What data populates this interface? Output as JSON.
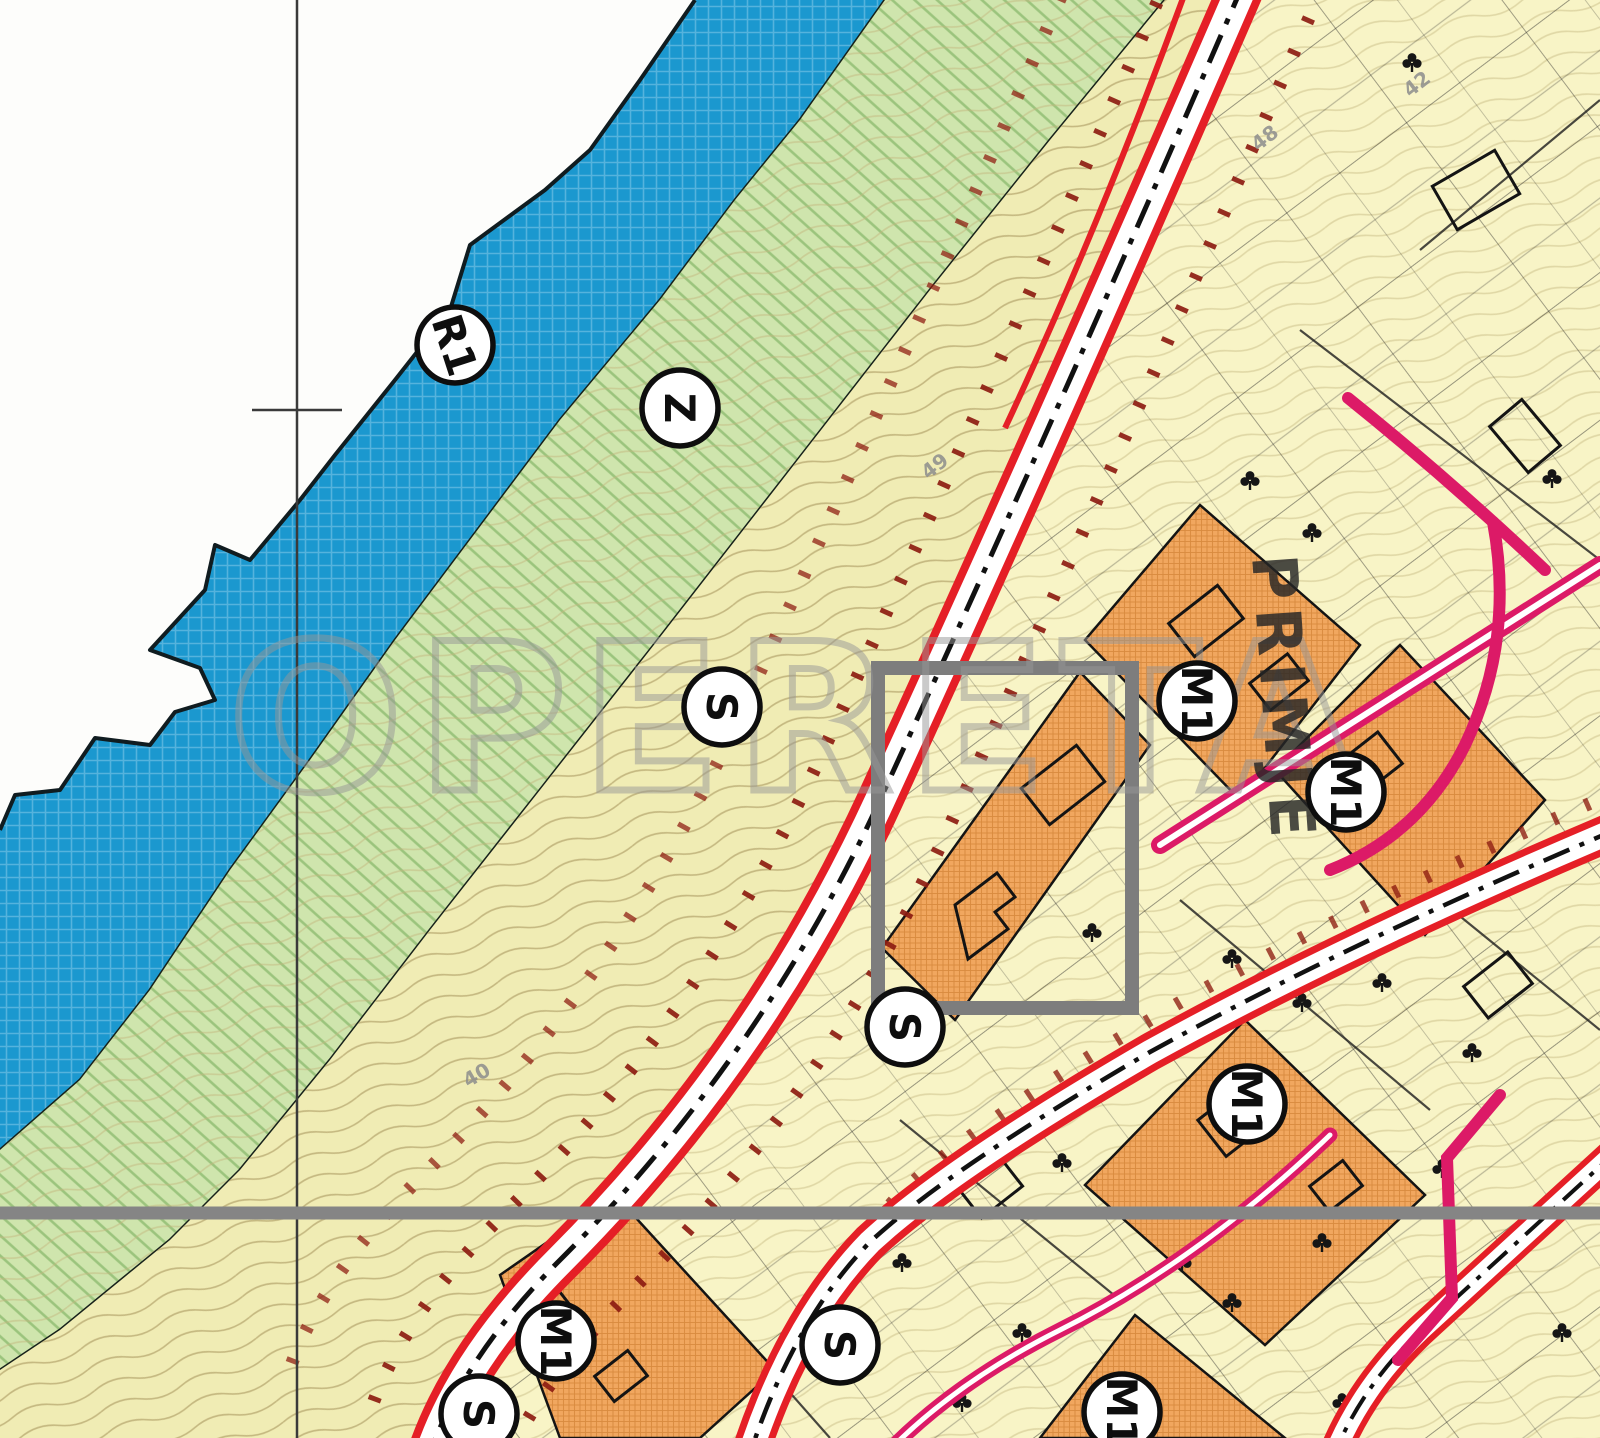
{
  "map": {
    "kind": "urban-zoning-plan-scan",
    "watermark": "OPERETA",
    "street_label": "PRIMJE",
    "zone_badges": [
      {
        "label": "R1",
        "x": 455,
        "y": 345,
        "rot": 72
      },
      {
        "label": "Z",
        "x": 680,
        "y": 408,
        "rot": 90
      },
      {
        "label": "S",
        "x": 722,
        "y": 707,
        "rot": 90
      },
      {
        "label": "S",
        "x": 905,
        "y": 1027,
        "rot": 90
      },
      {
        "label": "M1",
        "x": 1197,
        "y": 701,
        "rot": 90
      },
      {
        "label": "M1",
        "x": 1346,
        "y": 792,
        "rot": 90
      },
      {
        "label": "M1",
        "x": 1247,
        "y": 1104,
        "rot": 90
      },
      {
        "label": "M1",
        "x": 556,
        "y": 1341,
        "rot": 90
      },
      {
        "label": "S",
        "x": 840,
        "y": 1345,
        "rot": 90
      },
      {
        "label": "S",
        "x": 479,
        "y": 1414,
        "rot": 90
      },
      {
        "label": "M1",
        "x": 1122,
        "y": 1412,
        "rot": 90
      }
    ],
    "elevation_marks": [
      {
        "text": "49",
        "x": 928,
        "y": 480,
        "rot": -38
      },
      {
        "text": "48",
        "x": 1258,
        "y": 152,
        "rot": -38
      },
      {
        "text": "42",
        "x": 1410,
        "y": 98,
        "rot": -38
      },
      {
        "text": "40",
        "x": 468,
        "y": 1088,
        "rot": -30
      }
    ],
    "legend_colors": {
      "sea": "#1b98cf",
      "green_zone": "#cfe5ad",
      "green_hatch": "#8fbc70",
      "settlement_khaki": "#f0ecb4",
      "contour_line": "#c3b67e",
      "cadastral_yellow": "#f8f4c6",
      "mixed_use_orange": "#f1a75f",
      "orange_hatch": "#d88b3f",
      "road_red": "#e51f26",
      "setback_maroon": "#8e1d12",
      "road_magenta": "#dc1a67",
      "annotation_gray": "#858585"
    }
  }
}
